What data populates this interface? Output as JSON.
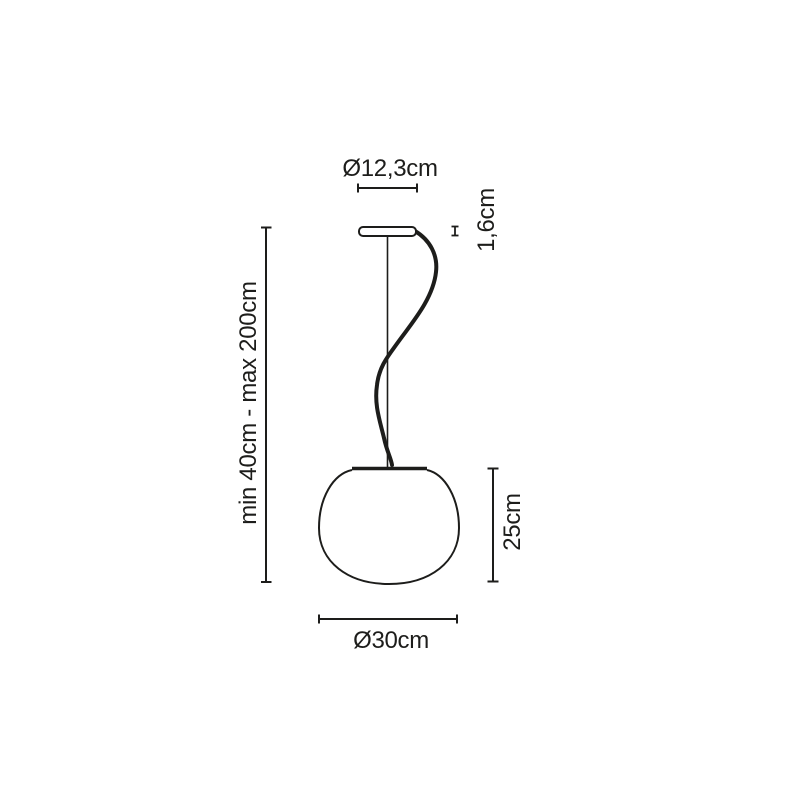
{
  "diagram": {
    "colors": {
      "line": "#1d1d1b",
      "background": "#ffffff"
    },
    "dimensions": {
      "canopy_diameter": {
        "label": "Ø12,3cm"
      },
      "canopy_height": {
        "label": "1,6cm"
      },
      "suspension_length": {
        "label": "min 40cm - max 200cm"
      },
      "shade_height": {
        "label": "25cm"
      },
      "shade_diameter": {
        "label": "Ø30cm"
      }
    }
  }
}
